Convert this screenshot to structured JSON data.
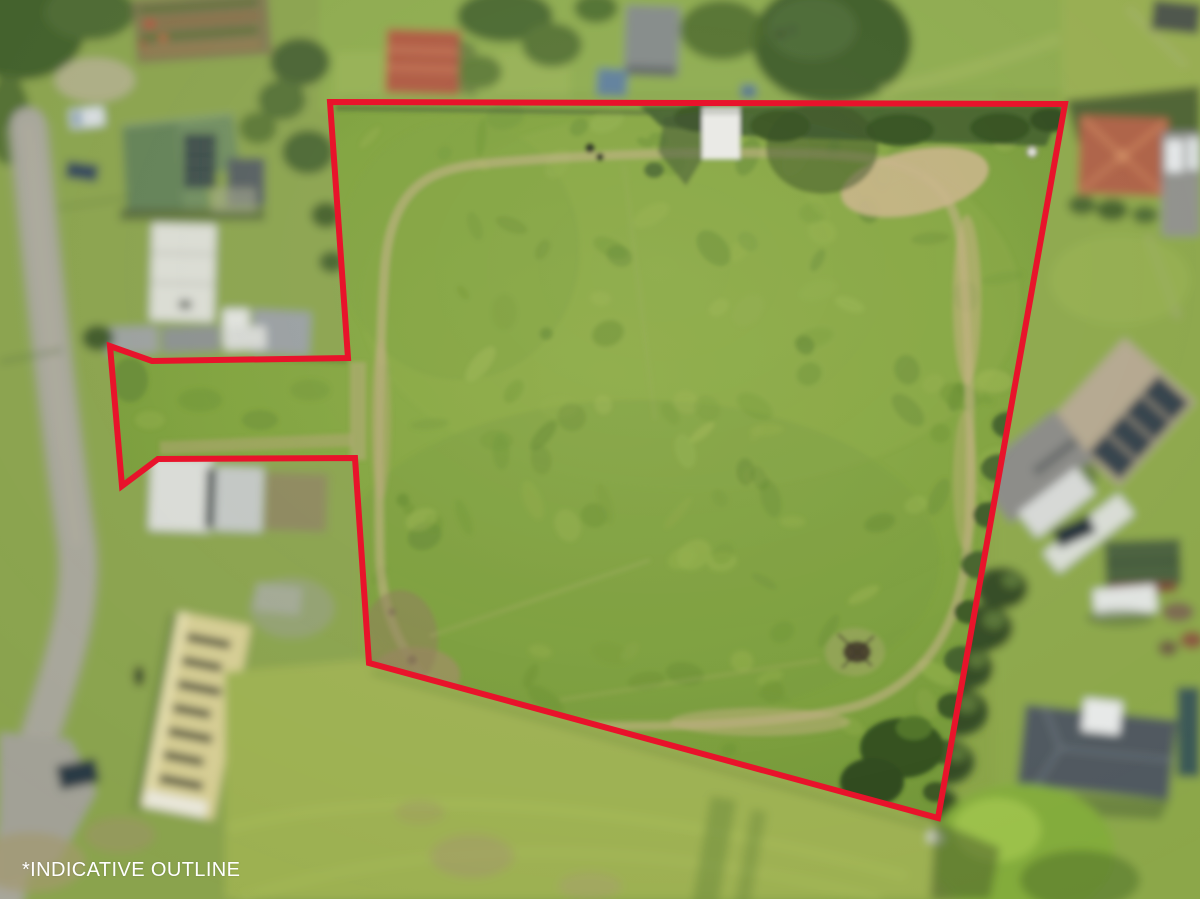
{
  "image": {
    "caption": "*INDICATIVE OUTLINE",
    "subject": "aerial drone view of a grassy paddock parcel outlined in red, surrounded by houses, gardens and a road"
  },
  "outline": {
    "points": "330,102 1065,104 938,818 369,663 355,458 158,459 122,486 110,346 152,361 348,358",
    "color": "#e8132b",
    "stroke_width": "6"
  },
  "palette": {
    "field_green": "#7fa03b",
    "lawn_green": "#9db151",
    "tree_green": "#3d5c28",
    "dirt_tan": "#c2b184",
    "road_gray": "#a7a69a",
    "caption_white": "#ffffff"
  }
}
